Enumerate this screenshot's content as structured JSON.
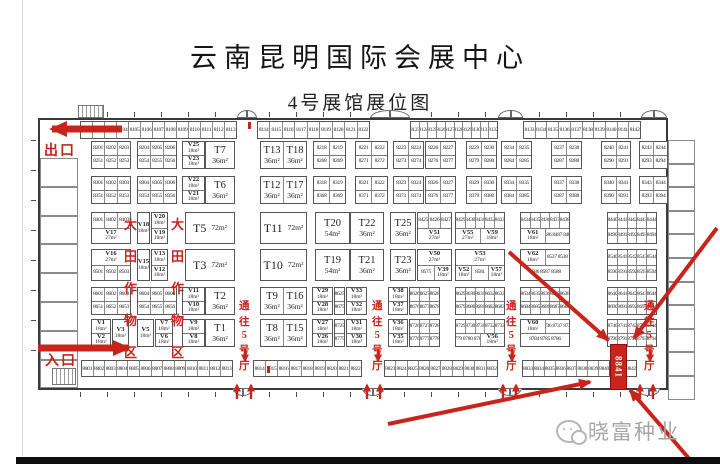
{
  "title": "云南昆明国际会展中心",
  "subtitle": "4号展馆展位图",
  "watermark": {
    "brand": "晓富种业"
  },
  "labels": {
    "exit": "出口",
    "entrance": "入口",
    "zone": "大田作物区",
    "aisle": "通往5号厅"
  },
  "colors": {
    "red": "#c8241c",
    "wall": "#3a3a3a",
    "highlight_fill": "#c8241c",
    "watermark_gray": "#a6a6a6"
  },
  "plan": {
    "hall": {
      "x": 38,
      "y": 118,
      "w": 630,
      "h": 272
    },
    "left_rooms": 8,
    "right_rooms": 11,
    "top_strip": [
      {
        "x": 80,
        "w": 157,
        "nums": "8101 8102 8103 8104 8105 8106 8107 8108 8109 8110 8111 8112 8113"
      },
      {
        "x": 257,
        "w": 113,
        "nums": "8114 8115 8116 8117 8118 8119 8120 8121 8122"
      },
      {
        "x": 410,
        "w": 88,
        "nums": "8123 8124 8125 8126 8127 8128 8129 8130 8131 8132"
      },
      {
        "x": 523,
        "w": 118,
        "nums": "8133 8134 8135 8136 8137 8138 8139 8140 8141 8142"
      }
    ],
    "top_doors": [
      {
        "x": 237,
        "w": 20
      },
      {
        "x": 370,
        "w": 40
      },
      {
        "x": 498,
        "w": 25
      },
      {
        "x": 641,
        "w": 26
      }
    ],
    "bottom_strip": [
      {
        "x": 81,
        "w": 152,
        "nums": "8801 8802 8803 8804 8805 8806 8807 8808 8809 8810 8811 8812 8813"
      },
      {
        "x": 253,
        "w": 109,
        "nums": "8814 8815 8816 8817 8818 8819 8820 8821 8822"
      },
      {
        "x": 384,
        "w": 114,
        "nums": "8823 8824 8825 8826 8827 8828 8829 8830 8831 8832"
      },
      {
        "x": 522,
        "w": 88,
        "nums": "8833 8834 8835 8836 8837 8838 8839 8840"
      },
      {
        "x": 625,
        "w": 12,
        "nums": "8842"
      }
    ],
    "bottom_doors": [
      {
        "x": 233,
        "w": 20
      },
      {
        "x": 362,
        "w": 22
      },
      {
        "x": 498,
        "w": 24
      },
      {
        "x": 637,
        "w": 23
      }
    ],
    "highlight": {
      "x": 610,
      "y": 344,
      "w": 15,
      "h": 44,
      "label": "8841"
    },
    "rows": [
      {
        "y": 141,
        "h": 28,
        "blocks": [
          [
            91,
            40,
            "8201|8202|8203",
            "8251|8252|8253"
          ],
          [
            137,
            40,
            "8204|8205|8206",
            "8254|8255|8256"
          ],
          [
            182,
            23,
            "V25 18m²",
            "V23 18m²"
          ],
          [
            205,
            30,
            "T7 36m²"
          ],
          [
            260,
            47,
            "T13 36m²|T18 36m²"
          ],
          [
            313,
            33,
            "8218|8219",
            "8268|8269"
          ],
          [
            355,
            33,
            "8221|8222",
            "8271|8272"
          ],
          [
            393,
            31,
            "8223|8224",
            "8273|8274"
          ],
          [
            425,
            31,
            "8226|8227",
            "8276|8277"
          ],
          [
            466,
            31,
            "8229|8230",
            "8279|8280"
          ],
          [
            501,
            31,
            "8234|8235",
            "8284|8285"
          ],
          [
            551,
            31,
            "8237|8238",
            "8287|8288"
          ],
          [
            601,
            30,
            "8240|8241",
            "8290|8291"
          ],
          [
            639,
            29,
            "8243|8244",
            "8293|8294"
          ]
        ]
      },
      {
        "y": 176,
        "h": 28,
        "blocks": [
          [
            91,
            40,
            "8301|8302|8303",
            "8351|8352|8353"
          ],
          [
            137,
            40,
            "8304|8305|8306",
            "8354|8355|8356"
          ],
          [
            182,
            23,
            "V22 18m²",
            "V21 18m²"
          ],
          [
            205,
            30,
            "T6 36m²"
          ],
          [
            260,
            47,
            "T12 36m²|T17 36m²"
          ],
          [
            313,
            33,
            "8318|8319",
            "8368|8369"
          ],
          [
            355,
            33,
            "8321|8322",
            "8371|8372"
          ],
          [
            393,
            31,
            "8323|8324",
            "8373|8374"
          ],
          [
            425,
            31,
            "8326|8327",
            "8376|8377"
          ],
          [
            466,
            31,
            "8329|8330",
            "8379|8380"
          ],
          [
            501,
            31,
            "8334|8335",
            "8384|8385"
          ],
          [
            551,
            31,
            "8337|8338",
            "8387|8388"
          ],
          [
            601,
            30,
            "8340|8341",
            "8390|8391"
          ],
          [
            639,
            29,
            "8343|8344",
            "8393|8394"
          ]
        ]
      },
      {
        "y": 212,
        "h": 32,
        "blocks": [
          [
            91,
            40,
            "8401|8402|8403",
            "V17 27m²"
          ],
          [
            137,
            13,
            "V18 18m²"
          ],
          [
            151,
            17,
            "V20 18m²",
            "V19 18m²"
          ],
          [
            185,
            50,
            "T5 72m²"
          ],
          [
            260,
            47,
            "T11 72m²"
          ],
          [
            315,
            35,
            "T20 54m²"
          ],
          [
            350,
            34,
            "T22 36m²"
          ],
          [
            390,
            26,
            "T25 36m²"
          ],
          [
            417,
            35,
            "8425|8426|8427",
            "V51 27m²"
          ],
          [
            455,
            50,
            "8429|8430|8431|8432|8433",
            "V55 27m²|V59 18m²"
          ],
          [
            520,
            50,
            "8434|8435|8436|8437|8438",
            "V61 18m²|8486 8487 8488"
          ],
          [
            607,
            50,
            "8440|8441|8442|8443|8444",
            "8490|8491|8492|8493|8494"
          ]
        ]
      },
      {
        "y": 249,
        "h": 32,
        "blocks": [
          [
            91,
            40,
            "V16 27m²",
            "8501|8502|8503"
          ],
          [
            137,
            13,
            "V15 18m²"
          ],
          [
            151,
            17,
            "V13 18m²",
            "V12 18m²"
          ],
          [
            185,
            50,
            "T3 72m²"
          ],
          [
            260,
            47,
            "T10 72m²"
          ],
          [
            315,
            35,
            "T19 54m²"
          ],
          [
            350,
            34,
            "T21 36m²"
          ],
          [
            390,
            26,
            "T23 36m²"
          ],
          [
            417,
            35,
            "V50 27m²",
            "8575|V39 18m²"
          ],
          [
            455,
            50,
            "V53 27m²",
            "V52 18m²|8581|V57 18m²"
          ],
          [
            520,
            50,
            "V62 18m²|8537 8538",
            "8586 8587 8588"
          ],
          [
            607,
            50,
            "8540|8541|8542|8543|8544",
            "8590|8591|8592|8593|8594"
          ]
        ]
      },
      {
        "y": 287,
        "h": 28,
        "blocks": [
          [
            91,
            40,
            "8601|8602|8603",
            "8651|8652|8653"
          ],
          [
            137,
            40,
            "8604|8605|8606",
            "8654|8655|8656"
          ],
          [
            182,
            23,
            "V11 18m²",
            "V10 18m²"
          ],
          [
            205,
            30,
            "T2 36m²"
          ],
          [
            260,
            47,
            "T9 36m²|T16 36m²"
          ],
          [
            312,
            21,
            "V29 18m²",
            "V28 18m²"
          ],
          [
            334,
            11,
            "8625",
            "8675"
          ],
          [
            346,
            21,
            "V33 18m²",
            "V32 18m²"
          ],
          [
            388,
            20,
            "V38 18m²",
            "V37 18m²"
          ],
          [
            409,
            31,
            "8626|8627|8628",
            "8676|8677|8678"
          ],
          [
            455,
            50,
            "8629|8630|8631|8632|8633",
            "8679|8680|8681|8682|8683"
          ],
          [
            520,
            50,
            "8634|8635|8636|8637|8638",
            "8684|8685|8686|8687|8688"
          ],
          [
            607,
            50,
            "8640|8641|8642|8643|8644",
            "8690|8691|8692|8693|8694"
          ]
        ]
      },
      {
        "y": 319,
        "h": 28,
        "blocks": [
          [
            91,
            20,
            "V1 18m²",
            "V2 18m²"
          ],
          [
            112,
            17,
            "V3 18m²"
          ],
          [
            137,
            17,
            "V5 18m²"
          ],
          [
            155,
            18,
            "V7 18m²",
            "V6 18m²"
          ],
          [
            182,
            23,
            "V9 18m²",
            "V8 18m²"
          ],
          [
            205,
            30,
            "T1 36m²"
          ],
          [
            260,
            47,
            "T8 36m²|T15 36m²"
          ],
          [
            312,
            21,
            "V27 18m²",
            "V26 18m²"
          ],
          [
            334,
            11,
            "8725",
            "8775"
          ],
          [
            346,
            21,
            "V31 18m²",
            "V30 18m²"
          ],
          [
            388,
            20,
            "V36 18m²",
            "V35 18m²"
          ],
          [
            409,
            31,
            "8726|8727|8728",
            "8776|8777|8778"
          ],
          [
            455,
            50,
            "8729|8730|8731|8732|8733",
            "8779 8780 8781|V56 18m²"
          ],
          [
            520,
            50,
            "V60 18m²|8736 8737 8738",
            "8784 8785 8786"
          ],
          [
            607,
            50,
            "8740|8741|8742|8743|8744",
            "8790|8791|8792|8793|8794"
          ]
        ]
      }
    ],
    "zones": [
      {
        "x": 124,
        "y": 214
      },
      {
        "x": 171,
        "y": 214
      }
    ],
    "aisles": [
      {
        "x": 239,
        "y": 298
      },
      {
        "x": 372,
        "y": 298
      },
      {
        "x": 506,
        "y": 298
      },
      {
        "x": 644,
        "y": 298
      }
    ],
    "marks": [
      {
        "x": 248,
        "y": 122
      },
      {
        "x": 267,
        "y": 366
      }
    ],
    "arrows": {
      "thick": [
        [
          122,
          129,
          52,
          129
        ],
        [
          38,
          348,
          128,
          348
        ]
      ],
      "big": [
        [
          388,
          424,
          590,
          382
        ],
        [
          509,
          252,
          608,
          340
        ],
        [
          717,
          228,
          634,
          338
        ],
        [
          692,
          462,
          630,
          390
        ]
      ],
      "small_up_x": [
        237,
        251,
        367,
        380,
        503,
        516,
        640,
        653
      ],
      "small_up_y": [
        399,
        385
      ],
      "small_down_x": [
        245,
        378,
        512,
        650
      ],
      "small_down_y": [
        349,
        361
      ]
    }
  }
}
